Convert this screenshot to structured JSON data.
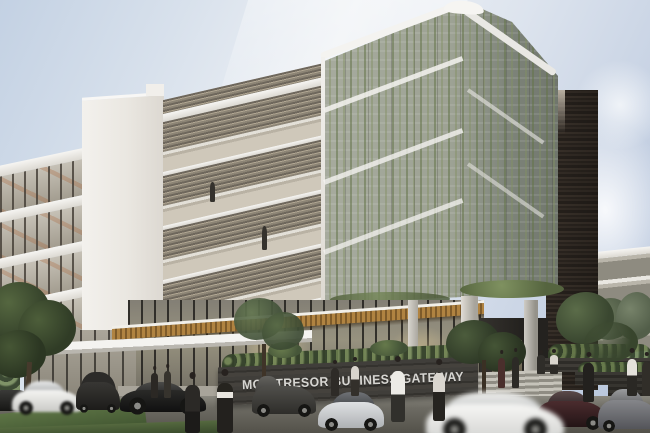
{
  "meta": {
    "kind": "architectural exterior rendering",
    "subject": "modern mixed-facade office building with green living screen, stone tower and entrance plaza"
  },
  "signage": {
    "building_name": "MON TRESOR BUSINESS GATEWAY"
  },
  "palette": {
    "sky_blue": "#b3c2da",
    "concrete_white": "#efede9",
    "vine_green": "#7d8f63",
    "vine_mesh_grey": "#9da294",
    "stone_brown": "#6b635c",
    "wood_canopy": "#a97f3f",
    "glass_warm": "#c9c3b6",
    "asphalt_grey": "#55534c",
    "grass_green": "#4f6a3c",
    "sign_wall_charcoal": "#3c3a36",
    "sign_text_grey": "#d6d5d1"
  }
}
